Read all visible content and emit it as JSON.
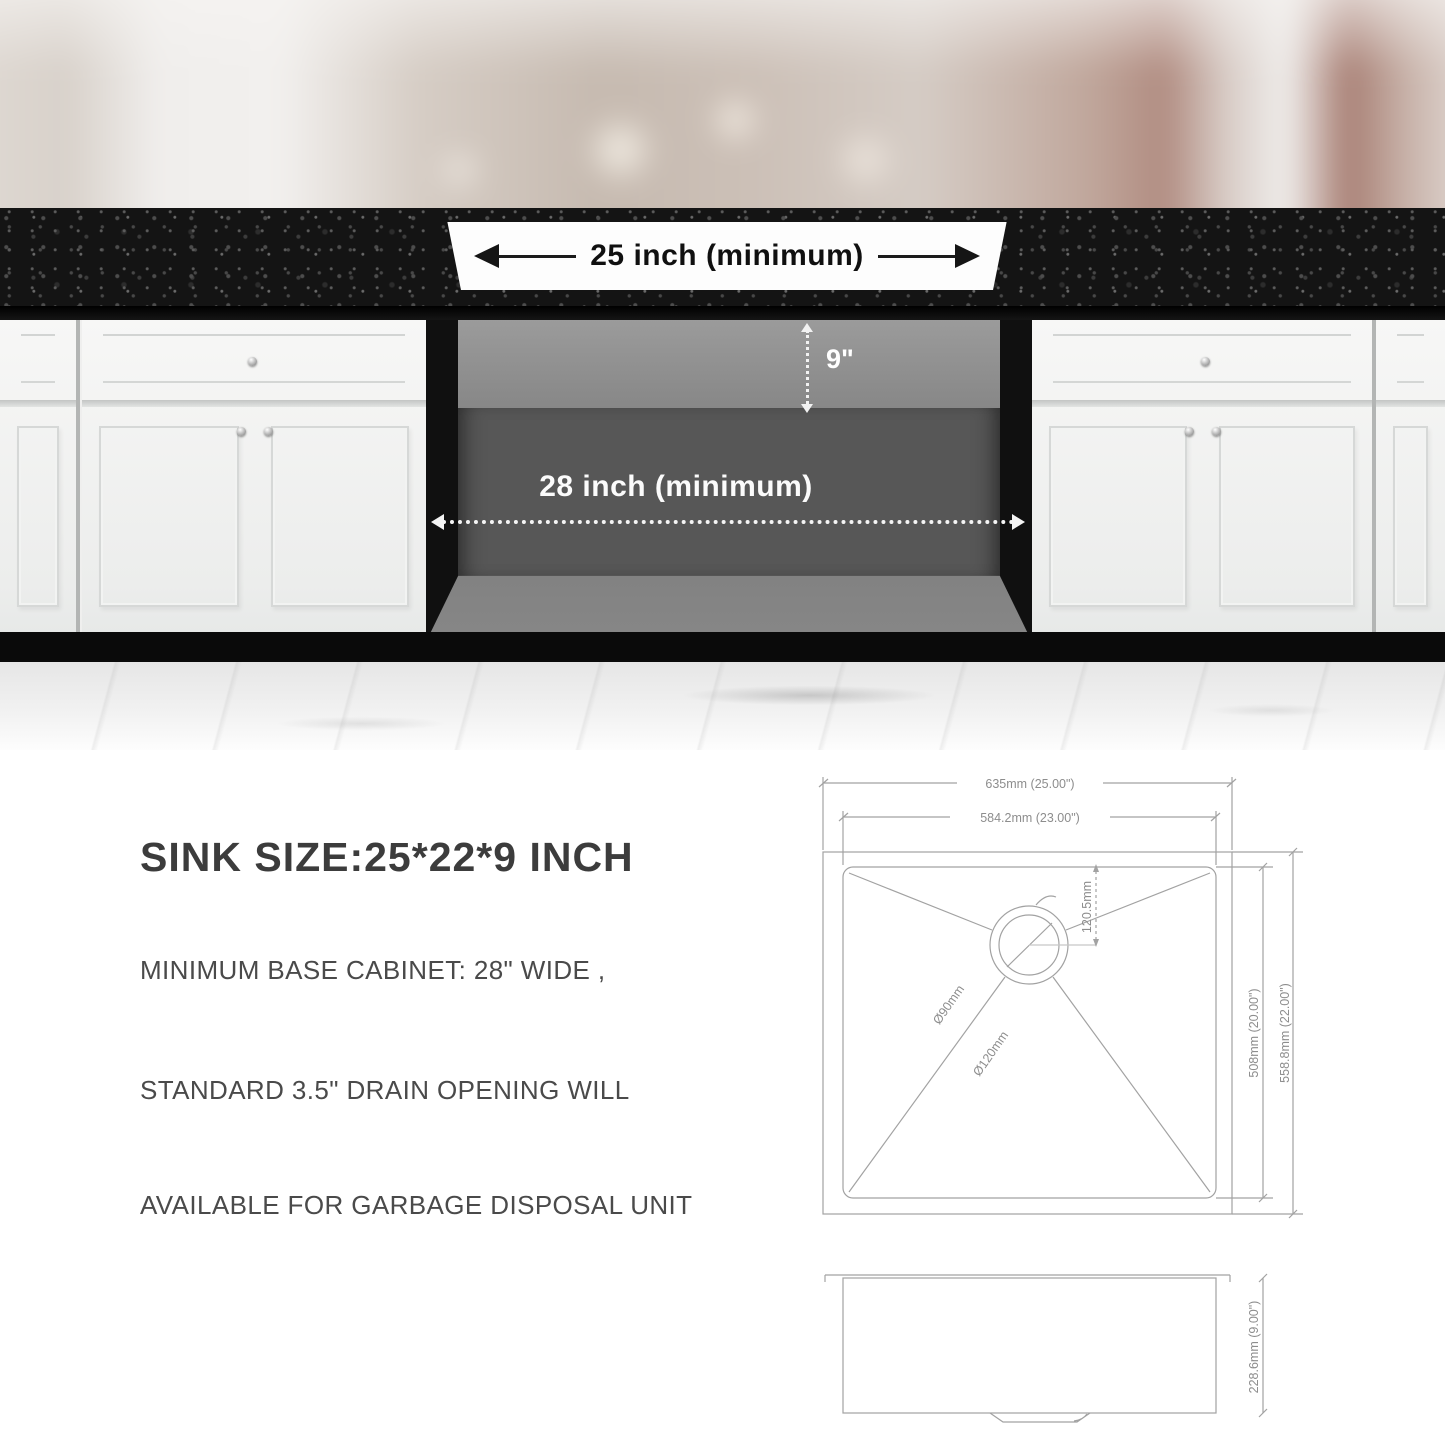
{
  "photo": {
    "countertop_width_label": "25 inch (minimum)",
    "opening_height_label": "9\"",
    "opening_width_label": "28 inch (minimum)"
  },
  "specs": {
    "title": "SINK SIZE:25*22*9 INCH",
    "lines": [
      "MINIMUM BASE CABINET: 28\" WIDE ,",
      "STANDARD 3.5\" DRAIN OPENING WILL",
      "AVAILABLE FOR GARBAGE DISPOSAL UNIT"
    ]
  },
  "diagram": {
    "top_view": {
      "outer_width_label": "635mm (25.00\")",
      "inner_width_label": "584.2mm (23.00\")",
      "inner_depth_label": "508mm (20.00\")",
      "outer_depth_label": "558.8mm (22.00\")",
      "drain_offset_label": "120.5mm",
      "drain_diameter_small_label": "Ø90mm",
      "drain_diameter_large_label": "Ø120mm"
    },
    "side_view": {
      "height_label": "228.6mm (9.00\")"
    }
  },
  "colors": {
    "granite": "#141414",
    "cabinet_face": "#f4f4f3",
    "opening_back_top": "#8f8f8f",
    "opening_back": "#575757",
    "opening_floor": "#7d7d7d",
    "photo_label_light": "#ffffff",
    "photo_label_dark": "#111111",
    "drawing_line": "#a2a2a2",
    "spec_text": "#4a4a4a"
  }
}
